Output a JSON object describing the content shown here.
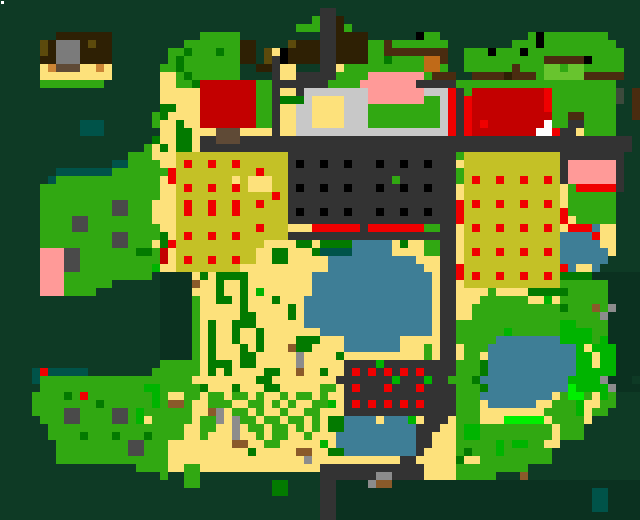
{
  "map": {
    "tile": 8,
    "cols": 80,
    "rows_count": 65,
    "width": 640,
    "height": 520,
    "palette": {
      ".": {
        "name": "dark-forest",
        "color": "#0e3a25"
      },
      ",": {
        "name": "darker-forest",
        "color": "#0b3120"
      },
      "G": {
        "name": "grass",
        "color": "#31a812"
      },
      "d": {
        "name": "dark-green-bush",
        "color": "#037a00"
      },
      "V": {
        "name": "vivid-green",
        "color": "#00b400"
      },
      "L": {
        "name": "lime-green",
        "color": "#00ef00"
      },
      "l": {
        "name": "light-green-crop",
        "color": "#68c42e"
      },
      "Y": {
        "name": "sand",
        "color": "#fde17b"
      },
      "M": {
        "name": "mustard-field",
        "color": "#c4c126"
      },
      "R": {
        "name": "bright-red",
        "color": "#f00000"
      },
      "r": {
        "name": "dark-red-roof",
        "color": "#c30000"
      },
      "P": {
        "name": "pink-roof",
        "color": "#ff9a98"
      },
      "A": {
        "name": "asphalt",
        "color": "#333333"
      },
      "K": {
        "name": "black",
        "color": "#000000"
      },
      "C": {
        "name": "light-gray-plaza",
        "color": "#c8c8c8"
      },
      "g": {
        "name": "gray-roof",
        "color": "#7b7b7b"
      },
      "h": {
        "name": "gray-rock-light",
        "color": "#8c8c8c"
      },
      "k": {
        "name": "gray-rock",
        "color": "#4a4a4a"
      },
      "B": {
        "name": "dark-brown-roof",
        "color": "#2e2004"
      },
      "b": {
        "name": "olive-brown",
        "color": "#5c4a0c"
      },
      "n": {
        "name": "log-brown",
        "color": "#4a2c10"
      },
      "u": {
        "name": "wood-brown",
        "color": "#5f4a36"
      },
      "U": {
        "name": "light-brown",
        "color": "#8a5a2a"
      },
      "o": {
        "name": "copper-orange",
        "color": "#c06a18"
      },
      "O": {
        "name": "tan-orange",
        "color": "#cc8535"
      },
      "W": {
        "name": "water",
        "color": "#3e7e96"
      },
      "T": {
        "name": "teal-pool",
        "color": "#005349"
      },
      "w": {
        "name": "white",
        "color": "#ffffff"
      },
      "m": {
        "name": "gray-green",
        "color": "#3c4a3c"
      }
    },
    "rows": [
      "................................................................................",
      "........................................AA......................................",
      ".......................................GAAB.....................................",
      ".....................................GGGAABG....................................",
      ".......BBBBBBB...........GGGGG..........AABBBB......KGG...........GKGGGGGGGG....",
      ".....bBgggBbBB.........GGGGGGGBB....bBBBAABBBBGGnGGGGGGG........GGGKGGGGGGGGG...",
      ".....bBgggBBBB.......GGdGGGdGGBB.bYKBBBBAABBBBGGnnnnnnnn..GGGKGGGKGGGGGGGGGGGG..",
      ".....BBgggBBBB.......GdGGGGGGGBB.bAKBBBBAABBBBGGdGGGGoon..GGGGGGGGGGnnnnnKGGGG..",
      ".....YOuuuYYOY......GGdGGGGGGG..BBAYY...AAYGGGGGGGGGGooG..GGGGGGnGGGllGllGGGGG..",
      ".....YYYYYYYYY......YYGdGGGGGG....AYYAAAAAGGGGPPPPPPPGnnn..nnnnBnnnGlllllnnnnn..",
      ".....GGGGGGGG.......YYGGdrrrrrrrGGAAAAAAAGGGGPPPPPPPAAAAAGGGGGGGGGGGGGGGGGGGG..",
      "....................YYYYYrrrrrrrGGAYYACCCCCCCCPPPPPPPCCCRAGrrrrrrrrrRGGGGGGGGm.n",
      "....................YYYYYrrrrrrrGGAdddCYYYYCCCPPPPPPPGGCRARrrrrrrrrrRGGGGGGGGm.n",
      "....................ddYYYrrrrrrrGGAYYCCYYYYCCCGGGGGGGGGCRARrrrrrrrrrRGGGGGGGG..n",
      "...................GdYYYYrrrrrrrGGAYYCCYYYYCCCGGGGGGGGGCRARrrrrrrrrrrGGnnGGGG..n",
      "..........TTT......GYYdYYrrrrrrrGGAYYCCYYYYCCCGGGGGGGGGCRARrRrrrrrrrwGGAAGGGG...",
      "..........TTT.......YYddYYYuuuYYYYAYYCCCCCCCCCCCCCCCCCCCRARrrrrrrrrwwRAAYGGGG...",
      "...................dYYddYAAuuuAAAAAAAAAAAAAAAAAAAAAAAAAAAAAAAAAAAAAAAAAAAAAAAAA",
      "..................GYdYddYAAAAAAAAAAAAAAAAAAAAAAAAAAAAAAAAAAAAAAAAAAAAAAAAAAAAAA",
      "................GGGYYYMMMMMMMMMMMMMMAAAAAAAAAAAAAAAAAAAAAGMMMMMMMMMMMMAAAAAAAA..",
      "..............TTGGGGYYMRMMRMMRMMMMMMAKAAKAAKAAAKAAKAAKAAAYMMMMMMMMMMMMAPPPPPPA..",
      ".......TTTTTTTGGGGGGGRMMMMMMMMMMRMMMAAAAAAAAAAAAAAAAAAAAAGMMMMMMMMMMMMAPPPPPPA..",
      "......TGGGGGGGGGGGGGYRMMMMMMMYMYYYMMAAAAAAAAAAAAAGAAAAAAAGMRMMRMMRMMRMAPPPPPPA..",
      ".....GGGGGGGGGGGGGGGYYMRMMRMMRMYYYMMAKAAKAAKAAAKAAKAAKAAAYMMMMMMMMMMMMYGRRRRRA..",
      ".....GGGGGGGGGGGGGGGYYMMMMMMMMMMMMRMAAAAAAAAAAAAAAAAAAAAAYMMMMMMMMMMMMYGGGGGG...",
      ".....GGGGGGGGGkkGGGYYYMRMMRMMRMMRMMMAAAAAAAAAAAAAAAAAAAAARMRMMRMMRMMRMYGGGGGG...",
      ".....GGGGGGGGGkkGGGYYYMRMMRMMRMMMMMMAKAAKAAKAAAKAAKAAKAAARMMMMMMMMMMMMRGGGGGG...",
      ".....GGGGkkGGGGGGGGYYYMMMMMMMMMMMMMMAAAAAAAAAAAAAAAAAAAAARMMMMMMMMMMMMRYGGGGG...",
      ".....GGGGkkGGGGGGGGGYYMMMMMMMMMMRMMMYYYRRRRRRARRRRRRRGGAAYMRMMRMMRMMRMYRRRWYY...",
      ".....GGGGGGGGGkkGGGGdYMRMMRMMRMMMMMMAAAAAAAAAAAAAAAAAAAAAYMMMMMMMMMMMMWWWWRYY...",
      ".....GGGGGGGGGkkGGGYdRMMMMMMMMMMMYYYYddYddddWWWWWYdYYGGAAYMMMMMMMMMMMMWWWWWYY...",
      ".....PPPkkGGGGGGGddGrYMMMMMMMMMMYYddYYYdTTTTWWWWWYYYYGGAAYMRMMRMMRMMRMWWWWWWY...",
      ".....PPPkkGGGGGGGGGGrYMRMMRMMRMMYYddYYYYYWWWWWWWWWWWYYYAAYMMMMMMMMMMMMWWWWWW....",
      ".....PPPkkGGGGGGGGGVYYMMMMMMMMYYYYYYYYYYYWWWWWWWWWWWWYYAARMMMMMMMMMMMMRWYYW.....",
      ".....PPPGGGGGGGGGGG.,,,,YdYddddYYYYYYYYWWWWWWWWWWWWWWWYAARMRMMRMMRMMRMdddd,,,,,,",
      ".....PPPGGGGGG......,,,,UYYdYYdYYYYYYYYWWWWWWWWWWWWWWWYAAYMMMMMMMMMMMMGGGGGG,,,,",
      ".....PPPGGGG........,,,,YYYdYYdYVYYYYYYWWWWWWWWWWWWWWWYAAYYYYGYYYYdddddGGGGG,,,,",
      "....................,,,,GYYddYdYYYdYYYWWWWWWWWWWWWWWWWYAAYYYGGGGGGYYVYGGGGGG,,,,",
      "....................,,,,GYYYYYdYYYYYdYWWWWWWWWWWWWWWWWYAAYYGGGGGGGGGGGdGGGUGh,,,",
      "....................,,,,GYYYYYddYYYYdYWWWWWWWWWWWWWWWWYAAYYGGGGGGGGGGGGGGGGh,,,,",
      "....................,,,,GYdYYdddYYYYYYWWWWWWWWWWWWWWWWYAAGGGGGGGGGGGGGVVGGGG,,,,",
      "....................,,,,GYdYYdYYdYYYYYYYWWWWWWWWWWWWWWYAAGGGGGGVGGGGGGVVVVGG,,,,",
      "....................,,,,GYdYYdYYdYYYYdddYYYWWWWWWWYYYYYAAGGGGGWWWWWWWWVVVVGV,,,,",
      "....................,,,,GYdYYYdYdYYYUddYYYYWWWWWWWYYYGYAAYGGGWWWWWWWWWWWVYVVV,,,",
      "....................,,,,GYdYYYddYYYYYhYYYYdYYYYYYYYYYGYAAYGGYWWWWWWWWWWWVVYVV,,,",
      "....................GGGGGYdddYddYYYYYhYYYYYAAAAVAAAAAAAAAGGGdWWWWWWWWWWWVVYVV,,,",
      "....TRTTTTT........GGGGGGYdYdYYYYddYYUYYdYYARARARARARAAAAGGGdWWWWWWWWWWWVVVVV,,,",
      "....TGGGGGGGGGGGGGGGGGGGYYYYYYYYddYYYYYYYYAAAAAAAVAAAVAAGGGdWWWWWWWWWWWVVVVh,,,",
      ".....GGGGGGGGGGGGGVVGGGGGdYYYdYYYddYYYYYGGYARAAARAAARAAAAGGGdWWWWWWWWWWLVVVVh,,,",
      "....GGGGdGRGGGGGGGGVGYYGGYGGYGGYGYYGYGGYGYYAAAAAAAAAAAAAAGGGWWWWWWWWWYGLLGYVG...",
      "....GGGGGGGGdGGGGGGVGUUGYYGGGYYGGYGYGYYGGVYARARARARARAAAAGGGYWWWWWWYYGGGVYYGG...",
      "....GGGGkkGGGGkkGVGGGGGGYYUhYGGYGYYGYYGGYYYAAAAAAAAAAAAAAGGGYYYYYYYYGGGGVYGG....",
      ".....GGGkkGGGGkkGVYGGGGGYGGhYhGGYGGYGGYGYddWWWWYWWWVYAAAYGGGYYYLLLLLYGGGGY......",
      "......GGGGGGGGGGGGGGGGGYYGGYYhYGGYGGYGYGYddWWWWWWWWWAAAYYGVVGGGGGGGGGYGGG.......",
      "......GGGGdGGGdGGGdGGGGYYGYYYhYYGYGGYYGYYYWWWWWWWWWWAAYYYGVVGGGGGGGGGYGGG.......",
      ".......GGGGGGGGGkkGGGYYYYYYYYUUYYGGYYYYYVYWWWWWWWWWWAAYYYGGGGGVGVVGGYY..........",
      ".......GGGGGGGGGkkGGGYYYYYYYYYYdYYYYYUUYYddWWWWWWWWWAYYYYGdGGGVGGGGGG...........",
      ".......GGGGGGGGGGGGGGYYYYYYYYYYYYYYYYYhYYYYYYYYYYYAAYYYYYdYYGGGGGGGGG...........",
      ".................GGGGYYGGYYYYYYYYYYYYYYYAAAAAAAAAAAAAYYYYGGGGGGGGG..............",
      "....................G..GG...............AAAAAAAhhAAAAYYYYGGGGG...U..............",
      ".......................GG.........dd....AA,,,,hUU,,,,,,,,,,,,,,,,,,,,,,,,,,,,,,,",
      "..................................dd....AA,,,,,,,,,,,,,,,,,,,,,,,,,,,,,,,,TT,,,,",
      "........................................AA,,,,,,,,,,,,,,,,,,,,,,,,,,,,,,,,TT,,,,",
      "........................................AA,,,,,,,,,,,,,,,,,,,,,,,,,,,,,,,,TT,,,,",
      "........................................AA,,,,,,,,,,,,,,,,,,,,,,,,,,,,,,,,,,,,,,"
    ]
  },
  "cursor": {
    "name": "map-cursor-dot",
    "x": 1,
    "y": 1,
    "w": 3,
    "h": 3,
    "color": "#ffffff"
  }
}
